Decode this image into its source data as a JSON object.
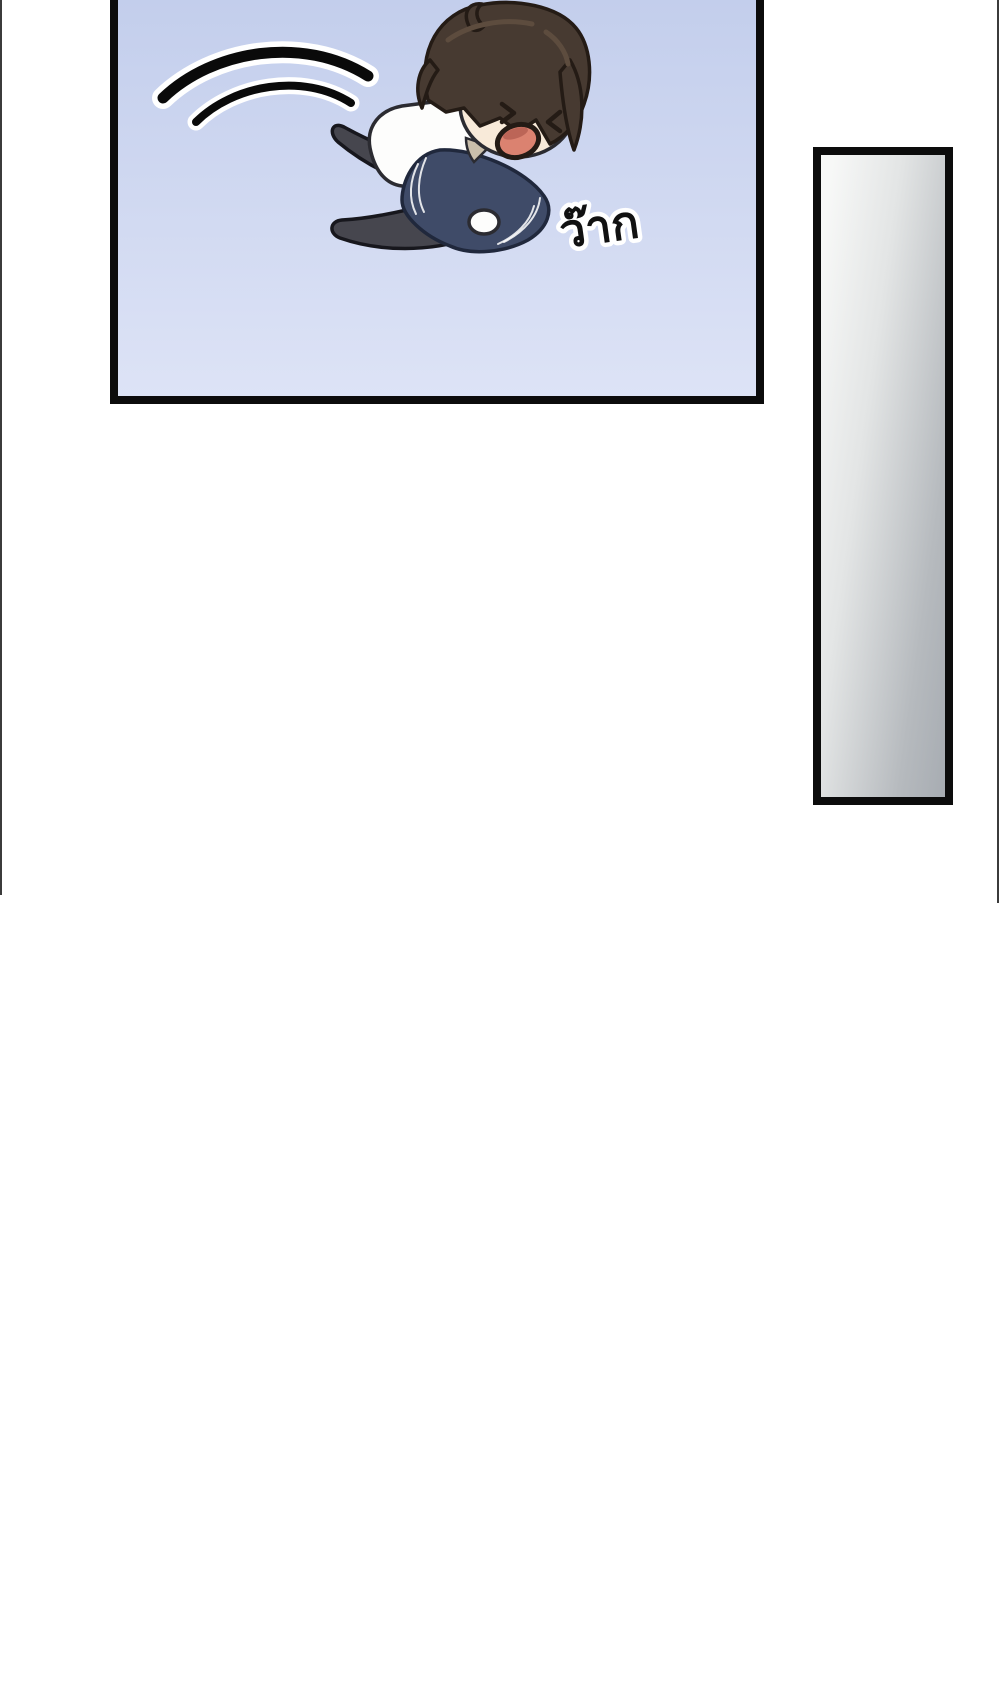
{
  "scene": {
    "kind": "webtoon comic page",
    "description": "chibi boy flung through the air, screaming, above a tall empty gray panel"
  },
  "main_panel": {
    "sfx_text": "ว๊าก"
  },
  "colors": {
    "page-bg": "#ffffff",
    "edge-line": "#3b3b3b",
    "panel-border": "#0c0c0c",
    "sky-top": "#c3ceec",
    "sky-bottom": "#dde3f6",
    "side-grad-left": "#f7f8f7",
    "side-grad-right": "#a7acb2",
    "speedline": "#0a0a0a",
    "speedline-casing": "#ffffff",
    "hair": "#473a31",
    "hair-dark": "#241b15",
    "hair-highlight": "#5d4c3e",
    "skin": "#f8ead9",
    "line": "#2b2b31",
    "shirt": "#fdfdfc",
    "collar": "#cabfab",
    "jacket": "#3f4b68",
    "jacket-line": "#20283c",
    "pants": "#46464e",
    "pants-line": "#17171d",
    "mouth": "#db8270",
    "mouth-dark": "#a34f43",
    "sfx-fill": "#111111",
    "sfx-outline": "#ffffff"
  }
}
